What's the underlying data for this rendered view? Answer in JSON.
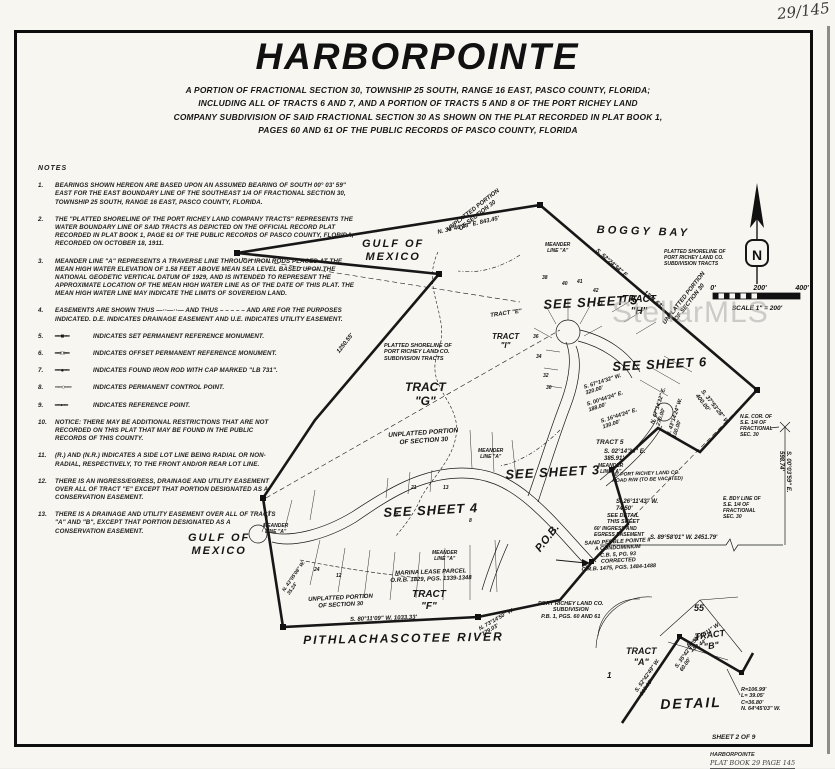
{
  "page": {
    "handwritten_corner": "29/145",
    "sheet_label": "SHEET 2 OF 9",
    "footer_line1": "HARBORPOINTE",
    "footer_line2": "PLAT BOOK 29  PAGE 145"
  },
  "header": {
    "title": "HARBORPOINTE",
    "subtitle_lines": [
      "A PORTION OF FRACTIONAL SECTION 30, TOWNSHIP 25 SOUTH, RANGE 16 EAST, PASCO COUNTY, FLORIDA;",
      "INCLUDING ALL OF TRACTS 6 AND 7, AND A PORTION OF TRACTS 5 AND 8 OF THE PORT RICHEY LAND",
      "COMPANY SUBDIVISION OF SAID FRACTIONAL SECTION 30 AS SHOWN ON THE PLAT RECORDED IN PLAT BOOK 1,",
      "PAGES 60 AND 61 OF THE PUBLIC RECORDS OF PASCO COUNTY, FLORIDA"
    ]
  },
  "watermark": {
    "text": "StellarMLS"
  },
  "compass": {
    "letter": "N"
  },
  "scalebar": {
    "t0": "0'",
    "t200": "200'",
    "t400": "400'",
    "caption": "SCALE 1\" = 200'"
  },
  "notes": {
    "heading": "NOTES",
    "items": [
      {
        "n": "1.",
        "text": "BEARINGS SHOWN HEREON ARE BASED UPON AN ASSUMED BEARING OF SOUTH 00° 03' 59\" EAST FOR THE EAST BOUNDARY LINE OF THE SOUTHEAST 1/4 OF FRACTIONAL SECTION 30, TOWNSHIP 25 SOUTH, RANGE 16 EAST, PASCO COUNTY, FLORIDA."
      },
      {
        "n": "2.",
        "text": "THE \"PLATTED SHORELINE OF THE PORT RICHEY LAND COMPANY TRACTS\" REPRESENTS THE WATER BOUNDARY LINE OF SAID TRACTS AS DEPICTED ON THE OFFICIAL RECORD PLAT RECORDED IN PLAT BOOK 1, PAGE 61 OF THE PUBLIC RECORDS OF PASCO COUNTY, FLORIDA, RECORDED ON OCTOBER 18, 1911."
      },
      {
        "n": "3.",
        "text": "MEANDER LINE \"A\" REPRESENTS A TRAVERSE LINE THROUGH IRON RODS PLACED AT THE MEAN HIGH WATER ELEVATION OF 1.58 FEET ABOVE MEAN SEA LEVEL BASED UPON THE NATIONAL GEODETIC VERTICAL DATUM OF 1929, AND IS INTENDED TO REPRESENT THE APPROXIMATE LOCATION OF THE MEAN HIGH WATER LINE AS OF THE DATE OF THIS PLAT.  THE MEAN HIGH WATER LINE MAY INDICATE THE LIMITS OF SOVEREIGN LAND."
      },
      {
        "n": "4.",
        "text": "EASEMENTS ARE SHOWN THUS —··—··— AND THUS – – – – – AND ARE FOR THE PURPOSES INDICATED.  D.E. INDICATES DRAINAGE EASEMENT AND U.E. INDICATES UTILITY EASEMENT."
      },
      {
        "n": "5.",
        "sym": "━━■━━",
        "text": "INDICATES SET PERMANENT REFERENCE MONUMENT."
      },
      {
        "n": "6.",
        "sym": "━━□━━",
        "text": "INDICATES OFFSET PERMANENT REFERENCE MONUMENT."
      },
      {
        "n": "7.",
        "sym": "━━●━━",
        "text": "INDICATES FOUND IRON ROD WITH CAP MARKED \"LB 731\"."
      },
      {
        "n": "8.",
        "sym": "╌·╌○╌·╌",
        "text": "INDICATES PERMANENT CONTROL POINT."
      },
      {
        "n": "9.",
        "sym": "━━•━━",
        "text": "INDICATES REFERENCE POINT."
      },
      {
        "n": "10.",
        "text": "NOTICE:  THERE MAY BE ADDITIONAL RESTRICTIONS THAT ARE NOT RECORDED ON THIS PLAT THAT MAY BE FOUND IN THE PUBLIC RECORDS OF THIS COUNTY."
      },
      {
        "n": "11.",
        "text": "(R.) AND (N.R.) INDICATES A SIDE LOT LINE BEING RADIAL OR NON-RADIAL, RESPECTIVELY, TO THE FRONT AND/OR REAR LOT LINE."
      },
      {
        "n": "12.",
        "text": "THERE IS AN INGRESS/EGRESS, DRAINAGE AND UTILITY EASEMENT OVER ALL OF TRACT \"E\" EXCEPT THAT PORTION DESIGNATED AS A CONSERVATION EASEMENT."
      },
      {
        "n": "13.",
        "text": "THERE IS A DRAINAGE AND UTILITY EASEMENT OVER ALL OF TRACTS \"A\" AND \"B\", EXCEPT THAT PORTION DESIGNATED AS A CONSERVATION EASEMENT."
      }
    ]
  },
  "map": {
    "labels": [
      {
        "n": "label-boggy-bay",
        "t": "BOGGY BAY",
        "x": 597,
        "y": 224,
        "r": 2,
        "s": 11,
        "ls": 3
      },
      {
        "n": "label-gulf-of-mexico-1",
        "t": "GULF OF\nMEXICO",
        "x": 362,
        "y": 238,
        "s": 11,
        "ls": 2,
        "al": "center"
      },
      {
        "n": "label-gulf-of-mexico-2",
        "t": "GULF OF\nMEXICO",
        "x": 188,
        "y": 532,
        "s": 11,
        "ls": 2,
        "al": "center"
      },
      {
        "n": "label-pithlachascotee-river",
        "t": "PITHLACHASCOTEE   RIVER",
        "x": 303,
        "y": 633,
        "r": -1,
        "s": 12,
        "ls": 2
      },
      {
        "n": "label-unplatted-portion-1",
        "t": "UNPLATTED PORTION\nOF SECTION 30",
        "x": 446,
        "y": 228,
        "r": -38,
        "s": 6,
        "al": "center"
      },
      {
        "n": "label-unplatted-portion-2",
        "t": "UNPLATTED PORTION\nOF SECTION 30",
        "x": 662,
        "y": 322,
        "r": -52,
        "s": 6,
        "al": "center"
      },
      {
        "n": "label-unplatted-portion-3",
        "t": "UNPLATTED PORTION\nOF SECTION 30",
        "x": 388,
        "y": 432,
        "r": -4,
        "s": 6.5,
        "al": "center"
      },
      {
        "n": "label-unplatted-portion-4",
        "t": "UNPLATTED PORTION\nOF SECTION 30",
        "x": 308,
        "y": 597,
        "r": -3,
        "s": 6,
        "al": "center"
      },
      {
        "n": "label-meander-line-1",
        "t": "MEANDER\nLINE \"A\"",
        "x": 545,
        "y": 243,
        "s": 5,
        "al": "center"
      },
      {
        "n": "label-meander-line-2",
        "t": "MEANDER\nLINE \"A\"",
        "x": 478,
        "y": 449,
        "s": 5,
        "al": "center"
      },
      {
        "n": "label-meander-line-3",
        "t": "MEANDER\nLINE \"A\"",
        "x": 598,
        "y": 464,
        "s": 5,
        "al": "center"
      },
      {
        "n": "label-meander-line-4",
        "t": "MEANDER\nLINE \"A\"",
        "x": 432,
        "y": 551,
        "s": 5,
        "al": "center"
      },
      {
        "n": "label-meander-line-5",
        "t": "MEANDER\nLINE \"A\"",
        "x": 263,
        "y": 524,
        "s": 5,
        "al": "center"
      },
      {
        "n": "label-see-sheet-5",
        "t": "SEE SHEET 5",
        "x": 543,
        "y": 297,
        "r": -3,
        "s": 13,
        "ls": 1
      },
      {
        "n": "label-see-sheet-6",
        "t": "SEE SHEET 6",
        "x": 612,
        "y": 359,
        "r": -3,
        "s": 13,
        "ls": 1
      },
      {
        "n": "label-see-sheet-3",
        "t": "SEE SHEET 3",
        "x": 505,
        "y": 467,
        "r": -3,
        "s": 13,
        "ls": 1
      },
      {
        "n": "label-see-sheet-4",
        "t": "SEE SHEET 4",
        "x": 383,
        "y": 505,
        "r": -3,
        "s": 13,
        "ls": 1
      },
      {
        "n": "label-tract-h",
        "t": "TRACT\n\"H\"",
        "x": 622,
        "y": 294,
        "s": 10,
        "al": "center"
      },
      {
        "n": "label-tract-g",
        "t": "TRACT\n\"G\"",
        "x": 405,
        "y": 380,
        "s": 12,
        "al": "center"
      },
      {
        "n": "label-tract-i",
        "t": "TRACT\n\"I\"",
        "x": 492,
        "y": 332,
        "s": 8,
        "al": "center"
      },
      {
        "n": "label-tract-e",
        "t": "TRACT \"E\"",
        "x": 490,
        "y": 313,
        "r": -8,
        "s": 6
      },
      {
        "n": "label-tract-f",
        "t": "TRACT\n\"F\"",
        "x": 412,
        "y": 589,
        "s": 10,
        "al": "center"
      },
      {
        "n": "label-tract-5",
        "t": "TRACT 5",
        "x": 596,
        "y": 439,
        "s": 6.5
      },
      {
        "n": "label-bearing-s0214",
        "t": "S. 02°14'34\" E.\n385.91'",
        "x": 604,
        "y": 449,
        "s": 6
      },
      {
        "n": "label-tract-a-detail",
        "t": "TRACT\n\"A\"",
        "x": 626,
        "y": 646,
        "s": 9,
        "al": "center"
      },
      {
        "n": "label-tract-b-detail",
        "t": "TRACT\n\"B\"",
        "x": 694,
        "y": 632,
        "r": -8,
        "s": 9,
        "al": "center"
      },
      {
        "n": "label-parcel-55",
        "t": "55",
        "x": 694,
        "y": 603,
        "s": 9
      },
      {
        "n": "label-parcel-1",
        "t": "1",
        "x": 607,
        "y": 671,
        "s": 8
      },
      {
        "n": "label-detail-title",
        "t": "DETAIL",
        "x": 660,
        "y": 696,
        "r": -2,
        "s": 14,
        "ls": 2
      },
      {
        "n": "label-pob",
        "t": "P.O.B.",
        "x": 533,
        "y": 547,
        "r": -52,
        "s": 11
      },
      {
        "n": "label-sand-pebble",
        "t": "SAND PEBBLE POINTE II\nA CONDOMINIUM\nC.B. 5, PG. 93\nCORRECTED\nO.R.B. 1475, PGS. 1484-1488",
        "x": 580,
        "y": 541,
        "r": -3,
        "s": 5.5,
        "al": "center"
      },
      {
        "n": "label-port-richey-sub",
        "t": "PORT RICHEY LAND CO.\nSUBDIVISION\nP.B. 1, PGS. 60 AND 61",
        "x": 538,
        "y": 601,
        "s": 5.5,
        "al": "center"
      },
      {
        "n": "label-marina-lease",
        "t": "MARINA LEASE PARCEL\nO.R.B. 1829, PGS. 1339-1348",
        "x": 390,
        "y": 571,
        "r": -2,
        "s": 6,
        "al": "center"
      },
      {
        "n": "label-road-rw",
        "t": "30' PORT RICHEY LAND CO.\nROAD R/W (TO BE VACATED)",
        "x": 612,
        "y": 473,
        "r": -2,
        "s": 5
      },
      {
        "n": "label-see-detail",
        "t": "SEE DETAIL\nTHIS SHEET",
        "x": 607,
        "y": 513,
        "s": 5.5
      },
      {
        "n": "label-ingress-egress",
        "t": "60' INGRESS AND\nEGRESS EASEMENT",
        "x": 594,
        "y": 527,
        "s": 5
      },
      {
        "n": "label-e-bdy-line",
        "t": "E. BDY LINE OF\nS.E. 1/4 OF\nFRACTIONAL\nSEC. 30",
        "x": 723,
        "y": 497,
        "s": 5
      },
      {
        "n": "label-ne-corner",
        "t": "N.E. COR. OF\nS.E. 1/4 OF\nFRACTIONAL\nSEC. 30",
        "x": 740,
        "y": 415,
        "s": 5
      },
      {
        "n": "label-platted-shoreline-1",
        "t": "PLATTED SHORELINE OF\nPORT RICHEY LAND CO.\nSUBDIVISION TRACTS",
        "x": 384,
        "y": 343,
        "s": 5.5
      },
      {
        "n": "label-platted-shoreline-2",
        "t": "PLATTED SHORELINE OF\nPORT RICHEY LAND CO.\nSUBDIVISION TRACTS",
        "x": 664,
        "y": 250,
        "s": 5
      },
      {
        "n": "label-bearing-843",
        "t": "N. 36°46'28\" E.      843.45'",
        "x": 437,
        "y": 230,
        "r": -13,
        "s": 6
      },
      {
        "n": "label-bearing-5224",
        "t": "S. 52°24'34\" E.",
        "x": 598,
        "y": 248,
        "r": 41,
        "s": 6
      },
      {
        "n": "label-dist-1301",
        "t": "1301.63'",
        "x": 646,
        "y": 290,
        "r": 41,
        "s": 6
      },
      {
        "n": "label-dist-1250",
        "t": "1250.55'",
        "x": 336,
        "y": 351,
        "r": -52,
        "s": 6
      },
      {
        "n": "label-bearing-8011",
        "t": "S. 80°11'09\" W.   1033.33'",
        "x": 350,
        "y": 617,
        "r": -2,
        "s": 6
      },
      {
        "n": "label-bearing-7314",
        "t": "N. 73°14'50\" W.\n129.03'",
        "x": 478,
        "y": 627,
        "r": -30,
        "s": 5.5
      },
      {
        "n": "label-bearing-3753",
        "t": "S. 37°53'28\" W.\n400.00'",
        "x": 704,
        "y": 389,
        "r": 52,
        "s": 6
      },
      {
        "n": "label-bearing-6714a",
        "t": "S. 67°14'32\" W.\n320.00'",
        "x": 583,
        "y": 385,
        "r": -18,
        "s": 5.5
      },
      {
        "n": "label-bearing-0044",
        "t": "S. 00°44'24\" E.\n188.00'",
        "x": 586,
        "y": 402,
        "r": -18,
        "s": 5.5
      },
      {
        "n": "label-bearing-1644",
        "t": "S. 16°44'24\" E.\n130.00'",
        "x": 600,
        "y": 419,
        "r": -18,
        "s": 5.5
      },
      {
        "n": "label-bearing-6714b",
        "t": "N. 67°14'32\" E.\n270.00'",
        "x": 650,
        "y": 423,
        "r": -72,
        "s": 5.5
      },
      {
        "n": "label-bearing-4314",
        "t": "N. 43°14'24\" W.\n100.00'",
        "x": 666,
        "y": 435,
        "r": -72,
        "s": 5.5
      },
      {
        "n": "label-bearing-2611",
        "t": "S. 26°11'43\" W.\n74.50'",
        "x": 616,
        "y": 499,
        "s": 6
      },
      {
        "n": "label-bearing-8958",
        "t": "S. 89°58'01\" W.   2451.79'",
        "x": 650,
        "y": 535,
        "s": 6
      },
      {
        "n": "label-bearing-0003",
        "t": "S. 00°03'59\" E.   598.74'",
        "x": 791,
        "y": 451,
        "r": 90,
        "s": 6
      },
      {
        "n": "label-detail-5417",
        "t": "N. 54°17'11\" W.\n182.44'",
        "x": 686,
        "y": 644,
        "r": -35,
        "s": 5.5
      },
      {
        "n": "label-detail-3542",
        "t": "S. 35°42'49\" W.\n60.00'",
        "x": 674,
        "y": 666,
        "r": -55,
        "s": 5.5
      },
      {
        "n": "label-detail-5242",
        "t": "S. 52°42'49\" W.\n213.09'",
        "x": 634,
        "y": 690,
        "r": -55,
        "s": 5.5
      },
      {
        "n": "label-detail-curve",
        "t": "R=106.99'\nL= 39.05'\nC=36.80'\nN. 64°45'03\" W.",
        "x": 741,
        "y": 687,
        "s": 5.5
      },
      {
        "n": "label-bearing-4305",
        "t": "N. 43°05'08\" W.\n35.24'",
        "x": 282,
        "y": 590,
        "r": -55,
        "s": 5
      },
      {
        "n": "lot-number",
        "t": "38",
        "x": 542,
        "y": 276,
        "s": 5
      },
      {
        "n": "lot-number",
        "t": "40",
        "x": 562,
        "y": 282,
        "s": 5
      },
      {
        "n": "lot-number",
        "t": "41",
        "x": 577,
        "y": 280,
        "s": 5
      },
      {
        "n": "lot-number",
        "t": "42",
        "x": 593,
        "y": 289,
        "s": 5
      },
      {
        "n": "lot-number",
        "t": "43",
        "x": 597,
        "y": 302,
        "s": 5
      },
      {
        "n": "lot-number",
        "t": "36",
        "x": 533,
        "y": 335,
        "s": 5
      },
      {
        "n": "lot-number",
        "t": "34",
        "x": 536,
        "y": 355,
        "s": 5
      },
      {
        "n": "lot-number",
        "t": "32",
        "x": 543,
        "y": 374,
        "s": 5
      },
      {
        "n": "lot-number",
        "t": "30",
        "x": 546,
        "y": 386,
        "s": 5
      },
      {
        "n": "lot-number",
        "t": "21",
        "x": 411,
        "y": 486,
        "s": 5
      },
      {
        "n": "lot-number",
        "t": "13",
        "x": 443,
        "y": 486,
        "s": 5
      },
      {
        "n": "lot-number",
        "t": "24",
        "x": 314,
        "y": 568,
        "s": 5
      },
      {
        "n": "lot-number",
        "t": "12",
        "x": 336,
        "y": 574,
        "s": 5
      },
      {
        "n": "lot-number",
        "t": "8",
        "x": 469,
        "y": 519,
        "s": 5
      },
      {
        "n": "lot-number",
        "t": "4",
        "x": 427,
        "y": 513,
        "s": 5
      },
      {
        "n": "lot-number",
        "t": "7",
        "x": 395,
        "y": 514,
        "s": 5
      }
    ]
  }
}
